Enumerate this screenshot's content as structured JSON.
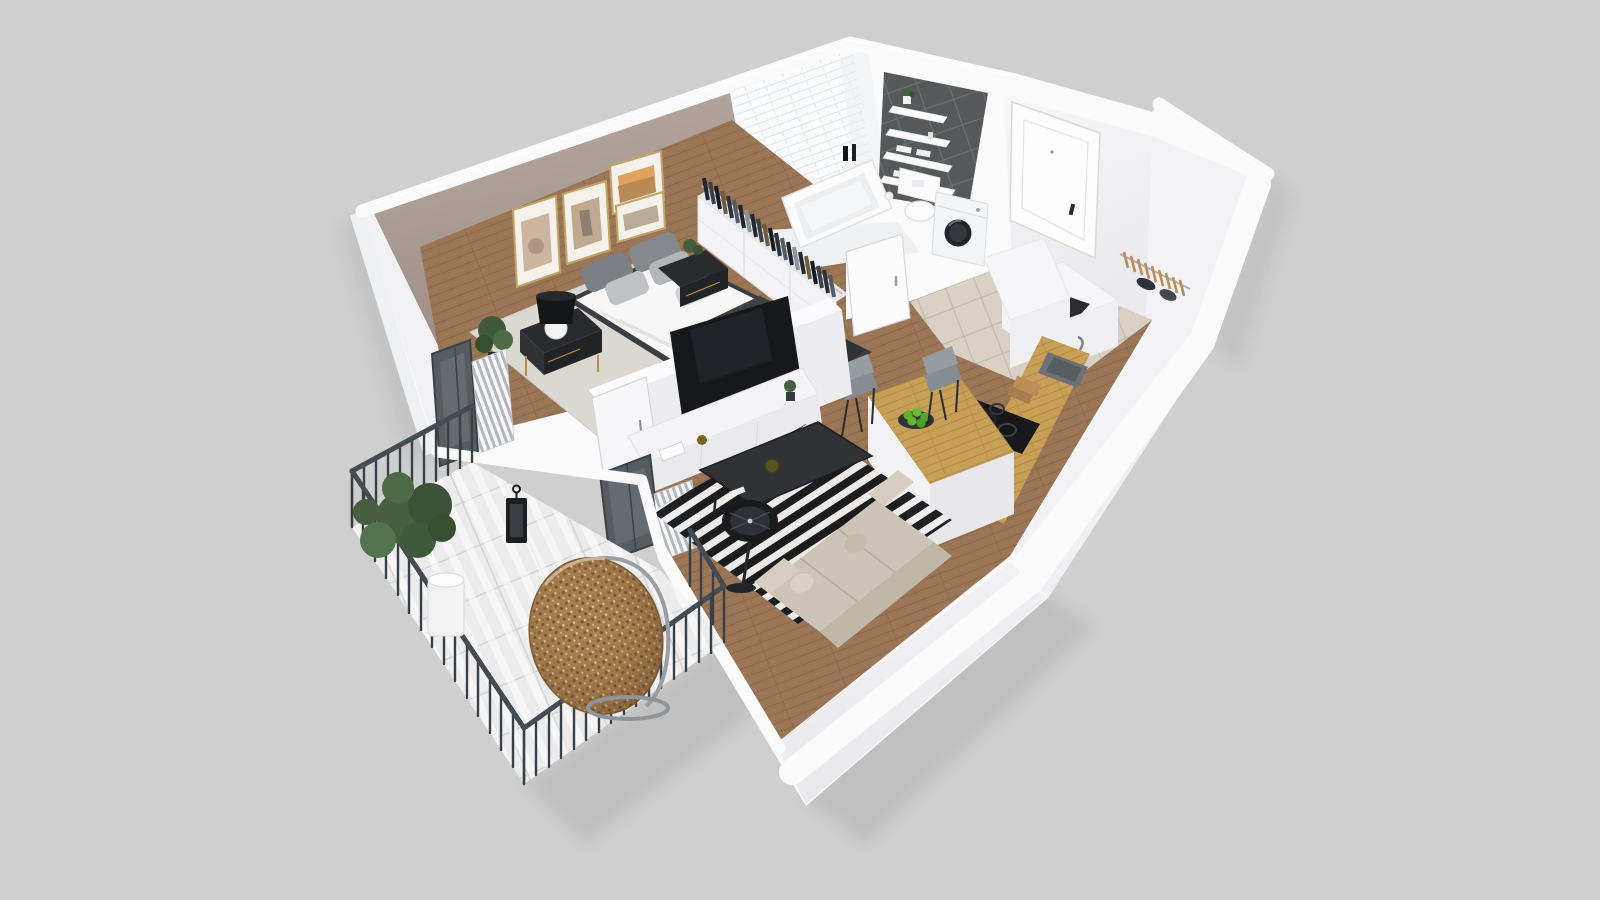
{
  "palette": {
    "bg": "#cfcfcf",
    "wallWhite": "#fafafb",
    "wallFace": "#efeff2",
    "wallShade": "#e4e4e9",
    "wallEdge": "#e2e2e6",
    "accentTop": "#b7a89e",
    "accentBottom": "#9d8f86",
    "wood": "#9b7656",
    "woodLine": "#85624668",
    "oak": "#c89f57",
    "oakLine": "#ae8440",
    "hallTile": "#d8d1c4",
    "hallTileLine": "#c3bbad",
    "balconyTile": "#ebeceb",
    "balconyTileLine": "#d3d4d5",
    "subway": "#fafbfc",
    "subwayLine": "#e2e4e7",
    "darkTile": "#56595a",
    "darkTileLine": "#6c6f70",
    "railing": "#3a4046",
    "railingRail": "#444b52",
    "charcoal": "#26282c",
    "tvBlack": "#17181b",
    "rugBlack": "#17181a",
    "rugWhite": "#efefef",
    "sofa": "#ccc5b7",
    "sofaBack": "#bfb8a9",
    "rattan": "#a87e4e",
    "rattanDark": "#7c5a35",
    "rattanLight": "#e3d2b8",
    "plantGreen": "#46603f",
    "appleGreen": "#5cb32c",
    "goldFrame": "#c2a368",
    "duvet": "#f7f7f8",
    "throwDark": "#2f3135",
    "pillowDark": "#7c7f83",
    "pillowLight": "#bfc2c5",
    "blackFurniture": "#28292d",
    "grayChair": "#939a9f",
    "metal": "#989ea3"
  },
  "scene": {
    "type": "3d-floorplan-render",
    "style": "isometric cutaway apartment",
    "rooms": [
      {
        "name": "bedroom",
        "items": [
          "double-bed",
          "nightstand-left",
          "nightstand-right",
          "table-lamp",
          "wall-art-frames",
          "wardrobe-with-clothes",
          "area-rug",
          "potted-plant",
          "accent-wall"
        ]
      },
      {
        "name": "bathroom",
        "items": [
          "bathtub",
          "toilet",
          "washing-machine",
          "wall-shelves",
          "towels",
          "subway-tile-wall",
          "dark-tile-wall",
          "bathroom-door"
        ]
      },
      {
        "name": "hallway",
        "items": [
          "front-door",
          "coat-rack-hangers",
          "shoe-cabinet",
          "beige-tile-floor"
        ]
      },
      {
        "name": "kitchen",
        "items": [
          "counter-with-sink",
          "cooktop-with-pans",
          "kitchen-island",
          "bar-chairs",
          "apple-bowl",
          "tall-cabinet"
        ]
      },
      {
        "name": "living-room",
        "items": [
          "wall-mounted-tv",
          "tv-stand",
          "striped-rug",
          "coffee-table",
          "floor-lamp",
          "sofa",
          "balcony-doors",
          "radiators"
        ]
      },
      {
        "name": "balcony",
        "items": [
          "metal-railing",
          "tile-floor",
          "hanging-egg-chair",
          "potted-tree",
          "lantern"
        ]
      }
    ],
    "counts": {
      "wall_art_frames": 4,
      "bar_chairs": 2,
      "bathroom_shelves": 4,
      "balcony_railing_sides": 4
    }
  }
}
